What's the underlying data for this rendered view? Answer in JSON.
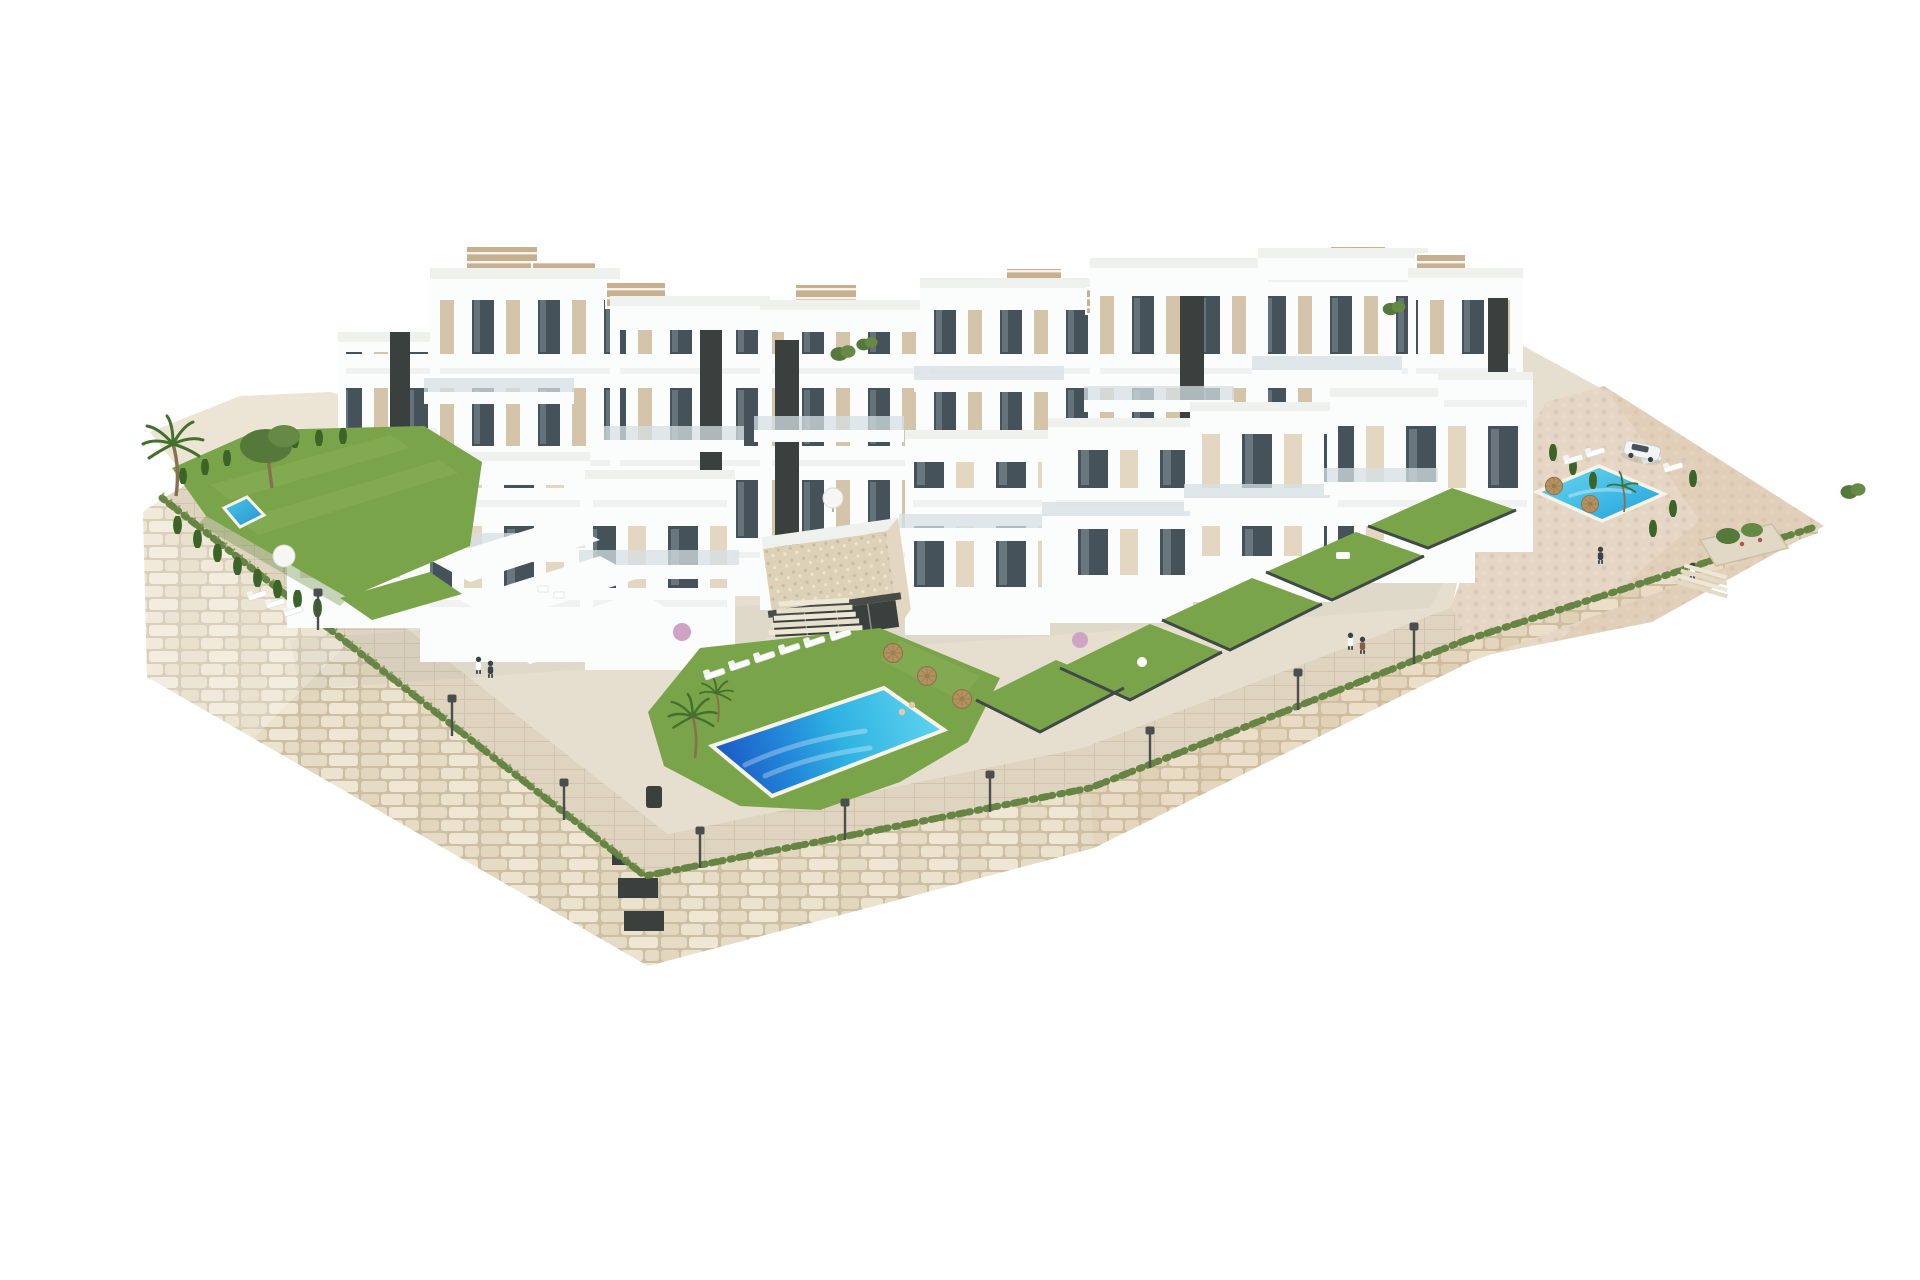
{
  "page": {
    "background": "#ffffff",
    "media_type": "3D architectural render",
    "subject": "Aerial view of a terraced white residential complex with pools, gardens and stone retaining walls"
  },
  "palette": {
    "bg": "#ffffff",
    "plateau": "#e6dfcf",
    "sand": "#ece5d6",
    "stone": "#e9e0cb",
    "stoneJoint": "#cdbfa3",
    "paving": "#ded4c0",
    "plaza": "#e5d6c5",
    "grass": "#7aa44a",
    "grassLight": "#8fb75c",
    "grassDark": "#61893a",
    "fringe": "#5f7f3c",
    "hedge": "#3c6428",
    "tree": "#55793b",
    "palm": "#44702e",
    "trunk": "#8a6f4e",
    "blossom": "#cfa3c4",
    "white": "#fbfcfc",
    "side": "#e9edee",
    "shade": "#d9e0e2",
    "roof": "#eff1ef",
    "beige": "#d4c4aa",
    "beigeL": "#e3d7c2",
    "glass": "#46525a",
    "glassLight": "#93a3ab",
    "core": "#3a403d",
    "rail": "#d6e0e4",
    "pergola": "#c7b08f",
    "poolTurquoise": "#4ac9e8",
    "poolMid": "#2fb3e2",
    "poolDeep": "#1b54c2",
    "poolEdge": "#f6f3e9",
    "umbrella": "#b3925f",
    "lampCol": "#4a4f4d",
    "carBody": "#f2f5f6",
    "carGlass": "#47525a",
    "person": "#3c4348",
    "accentRed": "#b0543f",
    "shadow": "#8e978f"
  },
  "scene": {
    "buildings": {
      "clusters": 2,
      "back_row_blocks": 8,
      "front_row_villas": 8,
      "floors_typical": "3-4",
      "features": [
        "white render facades",
        "beige accent panels",
        "dark glazed stair cores",
        "glass balustrade balconies",
        "rooftop pergolas with tan slats",
        "roof terraces"
      ]
    },
    "pools": [
      {
        "id": "main-pool",
        "location": "bottom center",
        "style": "large lap pool with deep blue end",
        "loungers": 6,
        "straw_umbrellas": 3,
        "swimmers": 2
      },
      {
        "id": "left-garden-pool",
        "location": "left private garden",
        "loungers": 3,
        "parasols": 1
      },
      {
        "id": "right-community-pool",
        "location": "right plaza",
        "loungers": 4,
        "straw_umbrellas": 2
      }
    ],
    "landscape": {
      "retaining_wall": "beige dry-stone masonry wrapping the site, grass fringe on top",
      "promenade": "paved walkway along wall crest with street lamps",
      "street_lamps": 9,
      "cypress_hedges": 3,
      "palm_trees": 4,
      "olive_tree": 1,
      "private_lawns_right_row": 5,
      "flowering_shrubs": 2,
      "planter_plaza": 1
    },
    "objects": {
      "car": {
        "count": 1,
        "type": "white SUV",
        "location": "right plaza"
      },
      "people": 6,
      "clubhouse": "stone-pebble clad pavilion with dark glazing near main pool",
      "stairs": [
        "central steps to pool lawn",
        "plaza steps right"
      ]
    }
  }
}
